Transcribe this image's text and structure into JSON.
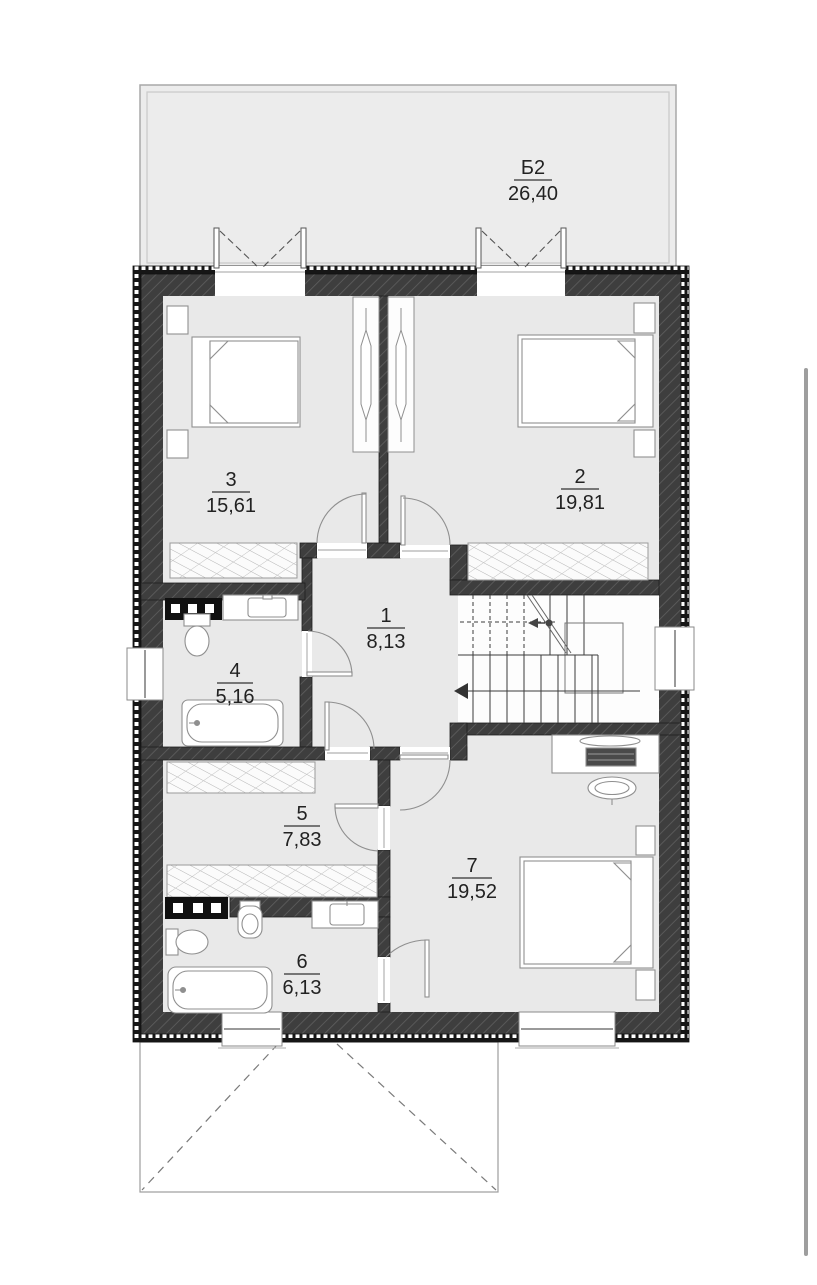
{
  "plan": {
    "balcony": {
      "label": "Б2",
      "area": "26,40"
    },
    "rooms": [
      {
        "number": "1",
        "area": "8,13"
      },
      {
        "number": "2",
        "area": "19,81"
      },
      {
        "number": "3",
        "area": "15,61"
      },
      {
        "number": "4",
        "area": "5,16"
      },
      {
        "number": "5",
        "area": "7,83"
      },
      {
        "number": "6",
        "area": "6,13"
      },
      {
        "number": "7",
        "area": "19,52"
      }
    ]
  },
  "colors": {
    "wall": "#3e3e3e",
    "wall_hatch": "#5d5d5d",
    "room_fill": "#e9e9e9",
    "balcony_fill": "#ececec",
    "furniture_line": "#8f8f8f",
    "text": "#222222",
    "scrollbar": "#9e9e9e"
  }
}
